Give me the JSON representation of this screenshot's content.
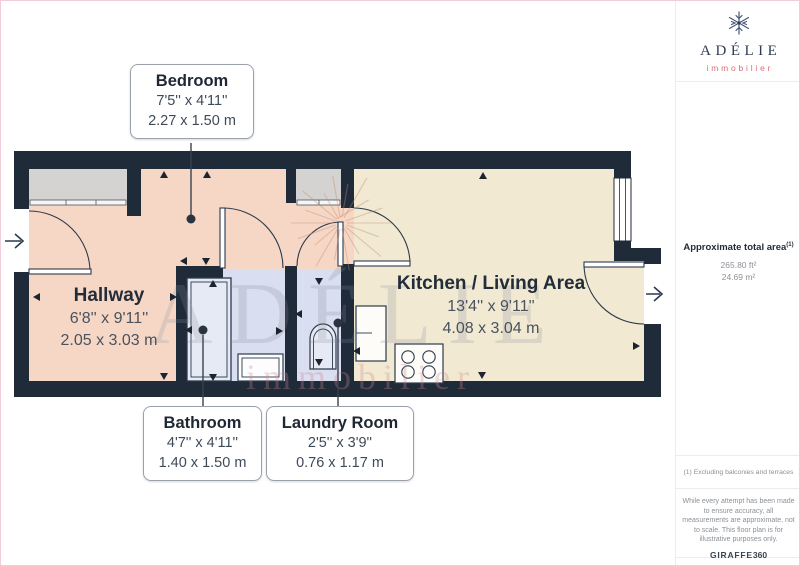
{
  "plan": {
    "rooms": {
      "bedroom": {
        "name": "Bedroom",
        "imperial": "7'5'' x 4'11''",
        "metric": "2.27 x 1.50 m"
      },
      "hallway": {
        "name": "Hallway",
        "imperial": "6'8'' x 9'11''",
        "metric": "2.05 x 3.03 m"
      },
      "kitchen_living": {
        "name": "Kitchen / Living Area",
        "imperial": "13'4'' x 9'11''",
        "metric": "4.08 x 3.04 m"
      },
      "bathroom": {
        "name": "Bathroom",
        "imperial": "4'7'' x 4'11''",
        "metric": "1.40 x 1.50 m"
      },
      "laundry": {
        "name": "Laundry Room",
        "imperial": "2'5'' x 3'9''",
        "metric": "0.76 x 1.17 m"
      }
    },
    "watermark": {
      "brand": "ADÉLIE",
      "tagline": "immobilier"
    }
  },
  "sidebar": {
    "logo": {
      "brand": "ADÉLIE",
      "tagline": "immobilier"
    },
    "area": {
      "label": "Approximate total area",
      "footnote_ref": "(1)",
      "imperial": "265.80 ft²",
      "metric": "24.69 m²"
    },
    "footnote": "(1) Excluding balconies and terraces",
    "disclaimer": "While every attempt has been made to ensure accuracy, all measurements are approximate, not to scale. This floor plan is for illustrative purposes only.",
    "credit": {
      "name": "GIRAFFE",
      "suffix": "360"
    }
  },
  "colors": {
    "wall": "#202b39",
    "hall_floor": "#f6d7c5",
    "kitchen_floor": "#f1e9d2",
    "wet_floor": "#d9def0",
    "closet_floor": "#d4d3d1",
    "accent_pink": "#dd6b76",
    "brand_navy": "#2e3d55",
    "page_border": "#f2ccd8"
  }
}
